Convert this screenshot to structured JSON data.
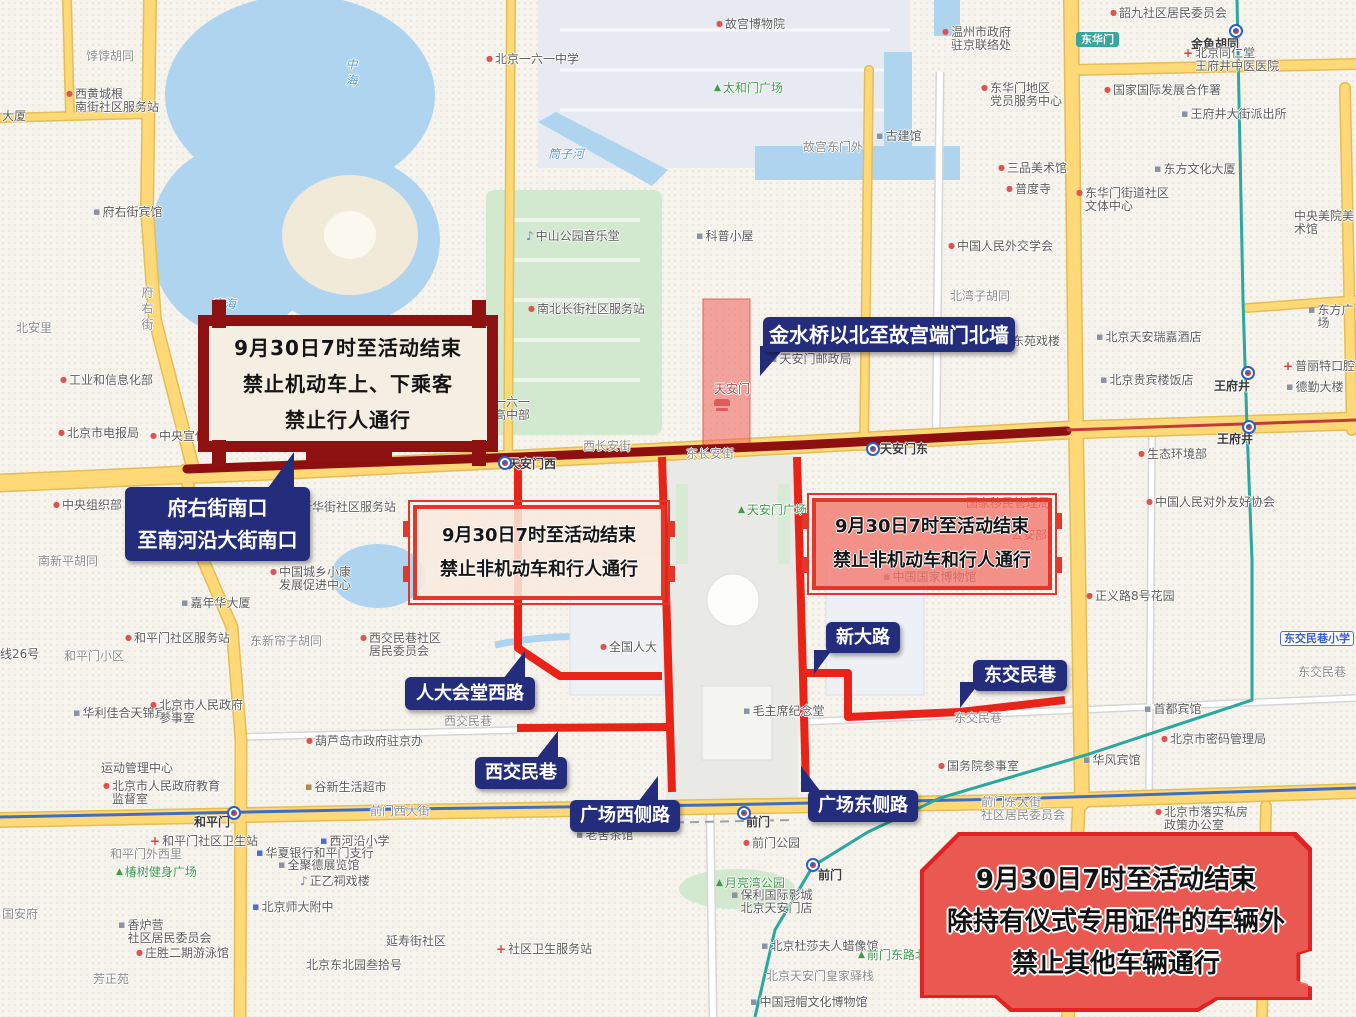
{
  "annotations": {
    "banner": {
      "lines": [
        "9月30日7时至活动结束",
        "禁止机动车上、下乘客",
        "禁止行人通行"
      ]
    },
    "restriction_left": {
      "lines": [
        "9月30日7时至活动结束",
        "禁止非机动车和行人通行"
      ]
    },
    "restriction_right": {
      "lines": [
        "9月30日7时至活动结束",
        "禁止非机动车和行人通行"
      ]
    },
    "ceremony": {
      "lines": [
        "9月30日7时至活动结束",
        "除持有仪式专用证件的车辆外",
        "禁止其他车辆通行"
      ]
    },
    "callouts": {
      "fuyoujie": {
        "line1": "府右街南口",
        "line2": "至南河沿大街南口"
      },
      "jinshuiqiao": {
        "text": "金水桥以北至故宫端门北墙"
      },
      "rendahuitang": {
        "text": "人大会堂西路"
      },
      "xijiaominxiang": {
        "text": "西交民巷"
      },
      "guangchangxi": {
        "text": "广场西侧路"
      },
      "guangchangdong": {
        "text": "广场东侧路"
      },
      "xindalu": {
        "text": "新大路"
      },
      "dongjiaominxiang": {
        "text": "东交民巷"
      }
    }
  },
  "colors": {
    "callout_navy": "#232d7b",
    "restricted_route_red": "#ea2318",
    "changan_dark_red": "#8e0f0f",
    "frame_red": "#e2382c",
    "ceremony_fill": "#ec615b",
    "road_yellow": "#ffd978",
    "water_blue": "#aed4f0",
    "metro_teal": "#2aa79e",
    "metro_blue": "#3f6fc4"
  },
  "map_labels": [
    {
      "text": "饽饽胡同",
      "x": 86,
      "y": 50,
      "cls": "street"
    },
    {
      "text": "西黄城根\n南街社区服务站",
      "x": 66,
      "y": 88,
      "cls": "poi",
      "icon": "dot"
    },
    {
      "text": "大厦",
      "x": 2,
      "y": 110,
      "cls": "poi"
    },
    {
      "text": "府右街宾馆",
      "x": 93,
      "y": 206,
      "cls": "poi",
      "icon": "bldg"
    },
    {
      "text": "府右街",
      "x": 140,
      "y": 286,
      "cls": "street",
      "v": true
    },
    {
      "text": "北安里",
      "x": 16,
      "y": 322,
      "cls": "street"
    },
    {
      "text": "工业和信息化部",
      "x": 60,
      "y": 374,
      "cls": "poi",
      "icon": "dot"
    },
    {
      "text": "北京市电报局",
      "x": 58,
      "y": 427,
      "cls": "poi",
      "icon": "dot"
    },
    {
      "text": "中央宣传部",
      "x": 150,
      "y": 430,
      "cls": "poi",
      "icon": "dot"
    },
    {
      "text": "中海",
      "x": 344,
      "y": 58,
      "cls": "water",
      "v": true
    },
    {
      "text": "南海",
      "x": 212,
      "y": 298,
      "cls": "water"
    },
    {
      "text": "筒子河",
      "x": 548,
      "y": 148,
      "cls": "water"
    },
    {
      "text": "北京一六一中学",
      "x": 486,
      "y": 53,
      "cls": "poi",
      "icon": "dot"
    },
    {
      "text": "京一六一\n学高中部",
      "x": 482,
      "y": 396,
      "cls": "poi"
    },
    {
      "text": "故宫博物院",
      "x": 716,
      "y": 18,
      "cls": "poi",
      "icon": "dot"
    },
    {
      "text": "太和门广场",
      "x": 714,
      "y": 82,
      "cls": "park",
      "icon": "tree"
    },
    {
      "text": "故宫东门外",
      "x": 803,
      "y": 141,
      "cls": "street"
    },
    {
      "text": "古建馆",
      "x": 876,
      "y": 130,
      "cls": "poi",
      "icon": "bldg"
    },
    {
      "text": "温州市政府\n驻京联络处",
      "x": 942,
      "y": 26,
      "cls": "poi",
      "icon": "dot"
    },
    {
      "text": "中山公园音乐堂",
      "x": 526,
      "y": 230,
      "cls": "poi",
      "icon": "music"
    },
    {
      "text": "科普小屋",
      "x": 696,
      "y": 230,
      "cls": "poi",
      "icon": "bldg"
    },
    {
      "text": "南北长街社区服务站",
      "x": 528,
      "y": 303,
      "cls": "poi",
      "icon": "dot"
    },
    {
      "text": "北湾子胡同",
      "x": 950,
      "y": 290,
      "cls": "street"
    },
    {
      "text": "中国人民外交学会",
      "x": 948,
      "y": 240,
      "cls": "poi",
      "icon": "dot"
    },
    {
      "text": "三品美术馆",
      "x": 998,
      "y": 162,
      "cls": "poi",
      "icon": "dot"
    },
    {
      "text": "普度寺",
      "x": 1006,
      "y": 183,
      "cls": "poi",
      "icon": "dot"
    },
    {
      "text": "东华门地区\n党员服务中心",
      "x": 981,
      "y": 82,
      "cls": "poi",
      "icon": "dot"
    },
    {
      "text": "天安门邮政局",
      "x": 770,
      "y": 353,
      "cls": "poi",
      "icon": "bldg"
    },
    {
      "text": "天安门",
      "x": 714,
      "y": 383,
      "cls": "red-poi"
    },
    {
      "text": "东苑戏楼",
      "x": 1003,
      "y": 335,
      "cls": "poi",
      "icon": "dot"
    },
    {
      "text": "韶九社区居民委员会",
      "x": 1110,
      "y": 7,
      "cls": "poi",
      "icon": "dot"
    },
    {
      "text": "金鱼胡同",
      "x": 1191,
      "y": 38,
      "cls": "station"
    },
    {
      "text": "北京同仁堂\n王府井中医医院",
      "x": 1183,
      "y": 47,
      "cls": "poi",
      "icon": "cross"
    },
    {
      "text": "国家国际发展合作署",
      "x": 1104,
      "y": 84,
      "cls": "poi",
      "icon": "dot"
    },
    {
      "text": "王府井大街派出所",
      "x": 1181,
      "y": 108,
      "cls": "poi",
      "icon": "bldg"
    },
    {
      "text": "东方文化大厦",
      "x": 1154,
      "y": 163,
      "cls": "poi",
      "icon": "bldg"
    },
    {
      "text": "东华门街道社区\n文体中心",
      "x": 1076,
      "y": 187,
      "cls": "poi",
      "icon": "dot"
    },
    {
      "text": "中央美院美术馆",
      "x": 1294,
      "y": 210,
      "cls": "poi"
    },
    {
      "text": "东方广场",
      "x": 1308,
      "y": 304,
      "cls": "poi",
      "icon": "bldg"
    },
    {
      "text": "北京天安瑞嘉酒店",
      "x": 1096,
      "y": 331,
      "cls": "poi",
      "icon": "bldg"
    },
    {
      "text": "普丽特口腔",
      "x": 1283,
      "y": 360,
      "cls": "poi",
      "icon": "cross"
    },
    {
      "text": "德勤大楼",
      "x": 1286,
      "y": 381,
      "cls": "poi",
      "icon": "bldg"
    },
    {
      "text": "北京贵宾楼饭店",
      "x": 1100,
      "y": 374,
      "cls": "poi",
      "icon": "bldg"
    },
    {
      "text": "王府井",
      "x": 1214,
      "y": 380,
      "cls": "station"
    },
    {
      "text": "王府井",
      "x": 1217,
      "y": 433,
      "cls": "station"
    },
    {
      "text": "生态环境部",
      "x": 1138,
      "y": 448,
      "cls": "poi",
      "icon": "dot"
    },
    {
      "text": "中国人民对外友好协会",
      "x": 1146,
      "y": 496,
      "cls": "poi",
      "icon": "dot"
    },
    {
      "text": "正义路8号花园",
      "x": 1086,
      "y": 590,
      "cls": "poi",
      "icon": "dot"
    },
    {
      "text": "东交民巷",
      "x": 1298,
      "y": 666,
      "cls": "street"
    },
    {
      "text": "首都宾馆",
      "x": 1144,
      "y": 703,
      "cls": "poi",
      "icon": "bldg"
    },
    {
      "text": "北京市密码管理局",
      "x": 1161,
      "y": 733,
      "cls": "poi",
      "icon": "dot"
    },
    {
      "text": "华风宾馆",
      "x": 1083,
      "y": 754,
      "cls": "poi",
      "icon": "bldg"
    },
    {
      "text": "国务院参事室",
      "x": 938,
      "y": 760,
      "cls": "poi",
      "icon": "dot"
    },
    {
      "text": "前门东大街\n社区居民委员会",
      "x": 981,
      "y": 796,
      "cls": "street"
    },
    {
      "text": "北京市落实私房\n政策办公室",
      "x": 1155,
      "y": 806,
      "cls": "poi",
      "icon": "dot"
    },
    {
      "text": "国家移民管理局",
      "x": 966,
      "y": 497,
      "cls": "red-poi"
    },
    {
      "text": "公安部",
      "x": 1011,
      "y": 529,
      "cls": "red-poi"
    },
    {
      "text": "中国国家博物馆",
      "x": 883,
      "y": 571,
      "cls": "poi",
      "icon": "bldg"
    },
    {
      "text": "西长安街",
      "x": 583,
      "y": 440,
      "cls": "street"
    },
    {
      "text": "东长安街",
      "x": 686,
      "y": 448,
      "cls": "street"
    },
    {
      "text": "天安门西",
      "x": 508,
      "y": 458,
      "cls": "station"
    },
    {
      "text": "天安门东",
      "x": 880,
      "y": 443,
      "cls": "station"
    },
    {
      "text": "天安门广场",
      "x": 738,
      "y": 504,
      "cls": "park",
      "icon": "tree"
    },
    {
      "text": "毛主席纪念堂",
      "x": 743,
      "y": 705,
      "cls": "poi",
      "icon": "bldg"
    },
    {
      "text": "全国人大",
      "x": 600,
      "y": 641,
      "cls": "poi",
      "icon": "dot"
    },
    {
      "text": "西交民巷",
      "x": 444,
      "y": 715,
      "cls": "street"
    },
    {
      "text": "东交民巷",
      "x": 954,
      "y": 712,
      "cls": "street"
    },
    {
      "text": "前门",
      "x": 746,
      "y": 816,
      "cls": "station"
    },
    {
      "text": "前门公园",
      "x": 743,
      "y": 837,
      "cls": "poi",
      "icon": "dot"
    },
    {
      "text": "月亮湾公园",
      "x": 716,
      "y": 877,
      "cls": "park",
      "icon": "tree"
    },
    {
      "text": "保利国际影城\n北京天安门店",
      "x": 731,
      "y": 889,
      "cls": "poi",
      "icon": "bldg"
    },
    {
      "text": "前门",
      "x": 818,
      "y": 869,
      "cls": "station"
    },
    {
      "text": "北京杜莎夫人蜡像馆",
      "x": 761,
      "y": 940,
      "cls": "poi",
      "icon": "bldg"
    },
    {
      "text": "北京天安门皇家驿栈",
      "x": 766,
      "y": 970,
      "cls": "street"
    },
    {
      "text": "中国冠帽文化博物馆",
      "x": 750,
      "y": 996,
      "cls": "poi",
      "icon": "bldg"
    },
    {
      "text": "前门东路北花园",
      "x": 858,
      "y": 949,
      "cls": "park",
      "icon": "tree"
    },
    {
      "text": "老舍茶馆",
      "x": 576,
      "y": 829,
      "cls": "poi",
      "icon": "bldg"
    },
    {
      "text": "前门西大街",
      "x": 370,
      "y": 805,
      "cls": "street"
    },
    {
      "text": "和平门",
      "x": 194,
      "y": 816,
      "cls": "station"
    },
    {
      "text": "运动管理中心",
      "x": 101,
      "y": 762,
      "cls": "poi"
    },
    {
      "text": "北京市人民政府教育\n监督室",
      "x": 103,
      "y": 780,
      "cls": "poi",
      "icon": "dot"
    },
    {
      "text": "谷新生活超市",
      "x": 305,
      "y": 781,
      "cls": "poi",
      "icon": "shop"
    },
    {
      "text": "和平门社区卫生站",
      "x": 150,
      "y": 835,
      "cls": "poi",
      "icon": "cross"
    },
    {
      "text": "和平门外西里",
      "x": 110,
      "y": 848,
      "cls": "street"
    },
    {
      "text": "椿树健身广场",
      "x": 116,
      "y": 866,
      "cls": "park",
      "icon": "tree"
    },
    {
      "text": "西河沿小学",
      "x": 320,
      "y": 835,
      "cls": "poi",
      "icon": "school"
    },
    {
      "text": "华夏银行和平门支行",
      "x": 256,
      "y": 847,
      "cls": "poi",
      "icon": "bank"
    },
    {
      "text": "全聚德展览馆",
      "x": 278,
      "y": 859,
      "cls": "poi",
      "icon": "bldg"
    },
    {
      "text": "正乙祠戏楼",
      "x": 300,
      "y": 875,
      "cls": "poi",
      "icon": "music"
    },
    {
      "text": "北京师大附中",
      "x": 252,
      "y": 901,
      "cls": "poi",
      "icon": "school"
    },
    {
      "text": "香炉营\n社区居民委员会",
      "x": 118,
      "y": 919,
      "cls": "poi",
      "icon": "bldg"
    },
    {
      "text": "庄胜二期游泳馆",
      "x": 136,
      "y": 947,
      "cls": "poi",
      "icon": "dot"
    },
    {
      "text": "芳正苑",
      "x": 93,
      "y": 973,
      "cls": "street"
    },
    {
      "text": "国安府",
      "x": 2,
      "y": 908,
      "cls": "street"
    },
    {
      "text": "北京东北园叁拾号",
      "x": 306,
      "y": 959,
      "cls": "poi"
    },
    {
      "text": "延寿街社区",
      "x": 386,
      "y": 935,
      "cls": "poi"
    },
    {
      "text": "社区卫生服务站",
      "x": 496,
      "y": 943,
      "cls": "poi",
      "icon": "cross"
    },
    {
      "text": "和平门小区",
      "x": 64,
      "y": 650,
      "cls": "street"
    },
    {
      "text": "线26号",
      "x": 0,
      "y": 648,
      "cls": "poi"
    },
    {
      "text": "和平门社区服务站",
      "x": 125,
      "y": 632,
      "cls": "poi",
      "icon": "dot"
    },
    {
      "text": "东新帘子胡同",
      "x": 250,
      "y": 635,
      "cls": "street"
    },
    {
      "text": "西交民巷社区\n居民委员会",
      "x": 360,
      "y": 632,
      "cls": "poi",
      "icon": "dot"
    },
    {
      "text": "嘉年华大厦",
      "x": 181,
      "y": 597,
      "cls": "poi",
      "icon": "bldg"
    },
    {
      "text": "中国城乡小康\n发展促进中心",
      "x": 270,
      "y": 566,
      "cls": "poi",
      "icon": "dot"
    },
    {
      "text": "南新平胡同",
      "x": 38,
      "y": 555,
      "cls": "street"
    },
    {
      "text": "中央组织部",
      "x": 53,
      "y": 499,
      "cls": "poi",
      "icon": "dot"
    },
    {
      "text": "新华街社区服务站",
      "x": 291,
      "y": 501,
      "cls": "poi",
      "icon": "dot"
    },
    {
      "text": "葫芦岛市政府驻京办",
      "x": 306,
      "y": 735,
      "cls": "poi",
      "icon": "dot"
    },
    {
      "text": "华利佳合天锦宾馆",
      "x": 73,
      "y": 707,
      "cls": "poi",
      "icon": "bldg"
    },
    {
      "text": "北京市人民政府\n参事室",
      "x": 150,
      "y": 699,
      "cls": "poi",
      "icon": "dot"
    },
    {
      "text": "东交民巷小学",
      "x": 1280,
      "y": 631,
      "cls": "school-badge"
    },
    {
      "text": "东华门",
      "x": 1076,
      "y": 32,
      "cls": "teal-badge"
    }
  ],
  "metro_icons": [
    {
      "x": 498,
      "y": 456
    },
    {
      "x": 866,
      "y": 442
    },
    {
      "x": 1241,
      "y": 366
    },
    {
      "x": 1242,
      "y": 420
    },
    {
      "x": 227,
      "y": 806
    },
    {
      "x": 737,
      "y": 806
    },
    {
      "x": 806,
      "y": 858
    },
    {
      "x": 1229,
      "y": 24
    }
  ]
}
